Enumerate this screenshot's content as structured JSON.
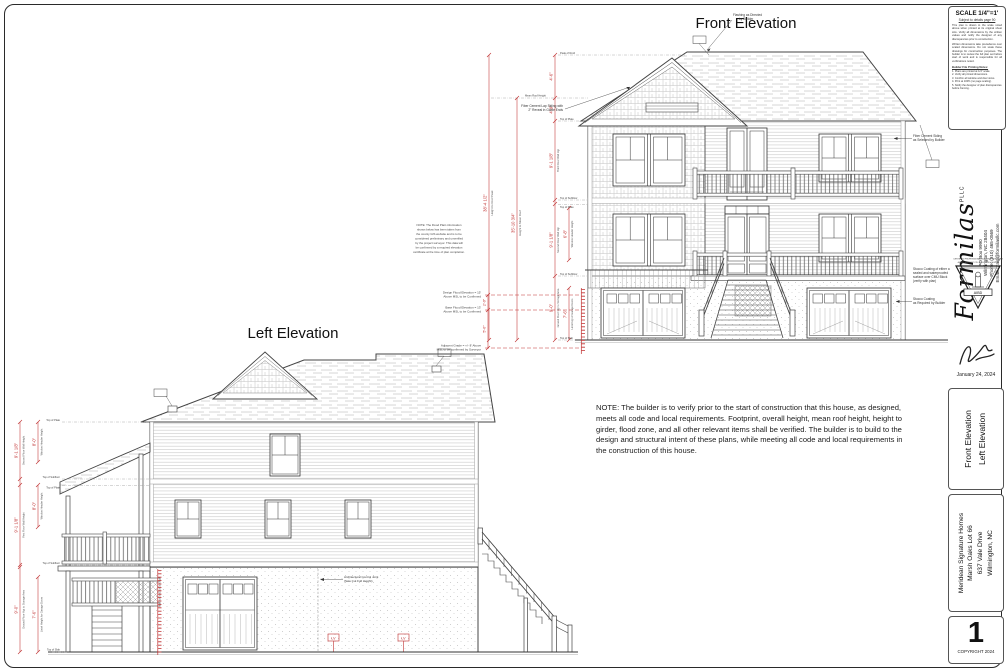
{
  "sheet": {
    "front_title": "Front Elevation",
    "left_title": "Left Elevation",
    "builder_note": "NOTE:  The builder is to verify prior to the start of construction that this house, as designed, meets all code and local requirements.  Footprint, overall height, mean roof height, height to girder, flood zone, and all other relevant items shall be verified.  The builder is to build to the design and structural intent of these plans, while meeting all code and local requirements in the construction of this house."
  },
  "labels": {
    "peak_of_roof": "Peak of Roof",
    "mean_roof": "Mean Roof Height",
    "top_of_plate": "Top of Plate",
    "top_of_subfloor": "Top of Subfloor",
    "top_of_slab": "Top of Slab"
  },
  "front": {
    "ann_flashing_1": "Flashing as Directed",
    "ann_flashing_2": "by Builder",
    "ann_gable_1": "Fiber Cement Lap Siding with",
    "ann_gable_2": "2\" Reveal in Gable Ends",
    "ann_siding_1": "Fiber Cement Siding",
    "ann_siding_2": "as Selected by Builder",
    "ann_stucco1_1": "Stucco Coating of either a",
    "ann_stucco1_2": "sealed and waterproofed",
    "ann_stucco1_3": "surface over CMU Block",
    "ann_stucco1_4": "(verify with plan)",
    "ann_stucco2_1": "Stucco Coating",
    "ann_stucco2_2": "as Required by Builder",
    "dim_seg_a": "4'-6\"",
    "dim_seg_b": "4'-9\"",
    "dim_floor3": "9'-1 1/8\"",
    "dim_floor3_lbl": "Third Floor Wall Hgt",
    "dim_floor2": "9'-1 1/8\"",
    "dim_floor2_lbl": "Second Floor Wall Hgt",
    "dim_header": "6'-8\"",
    "dim_header_lbl": "Window Header Height",
    "dim_ground": "9'-0\"",
    "dim_ground_lbl": "Ground Floor Hgt to Storage Area",
    "dim_lintel": "7'-6\"",
    "dim_lintel_lbl": "Lintel Hgt of Garage Doors",
    "dim_overall1": "38'-4 1/2\"",
    "dim_overall1_lbl": "Height to Roof Peak",
    "dim_overall2": "35'-10 3/4\"",
    "dim_overall2_lbl": "Height to Mean Roof"
  },
  "flood": {
    "note_l1": "NOTE:  The Flood Plain information",
    "note_l2": "shown below has been taken from",
    "note_l3": "the county GIS website and is to be",
    "note_l4": "considered preliminary and unverified",
    "note_l5": "by the project surveyor.  This data will",
    "note_l6": "be confirmed by a required elevation",
    "note_l7": "certificate at the time of plan completion.",
    "dfe_1": "Design Flood Elevation = 15'",
    "dfe_2": "Above MSL to be Confirmed",
    "bfe_1": "Base Flood Elevation = 13'",
    "bfe_2": "Above MSL to be Confirmed",
    "grade_1": "Adjacent Grade = +/- 8' Above",
    "grade_2": "MSL to be confirmed by Surveyor",
    "dim_a": "2'-0\"",
    "dim_b": "5'-0\""
  },
  "left": {
    "dim_floor": "9'-1 1/8\"",
    "dim_floor2_lbl": "Second Floor Wall Height",
    "dim_floor1_lbl": "First Floor Wall Height",
    "dim_header": "8'-0\"",
    "dim_header_lbl": "Window Header Height",
    "dim_ground": "9'-0\"",
    "dim_ground_lbl": "Ground Floor Hgt to Storage Area",
    "dim_lintel": "7'-6\"",
    "dim_lintel_lbl": "Lintel Height for Garage Doors",
    "ann_joint_1": "Architectural Control Joint",
    "ann_joint_2": "(Saw Cut Full Height)",
    "vent": "LV"
  },
  "titleblock": {
    "scale_title": "SCALE 1/4\"=1'",
    "scale_sub": "Subject to details page 90",
    "scale_para1": "This plan is drawn to the scale noted above when printed at its original sheet size.  Verify all dimensions by the written values and notify the designer of any discrepancies prior to construction.",
    "scale_para2": "Written dimensions take precedence over scaled dimensions.  Do not scale these drawings for construction purposes.  The builder is to review the full plan set before start of work and is responsible for all verifications noted.",
    "notes_title": "Builder File Printing Notes:",
    "notes": [
      "1.  Plans are printed at 1/4\" scale.",
      "2.  Verify all printed dimensions.",
      "3.  Confirm all window and door sizes.",
      "4.  Print at 100% (no page scaling).",
      "5.  Notify the designer of plan discrepancies before framing."
    ],
    "firm_name": "Formilas",
    "firm_suffix": "PLLC",
    "firm_address1": "PO Box 9990",
    "firm_address2": "Wilmington, NC 28404",
    "firm_phone": "Phone:  (910) 465-0569",
    "firm_email": "Email:  craig@formilasllc.com",
    "seal_top": "CERTIFIED PROFESSIONAL BUILDING DESIGNER",
    "seal_sub": "AMERICAN INSTITUTE OF BUILDING DESIGN",
    "seal_banner": "AIBD",
    "date": "January 24, 2024",
    "sheet_name_line1": "Front Elevation",
    "sheet_name_line2": "Left Elevation",
    "project_line1": "Meridean Signature Homes",
    "project_line2": "Marsh Oaks Lot 66",
    "project_line3": "637 Vale Drive",
    "project_line4": "Wilmington, NC",
    "sheet_number": "1",
    "copyright": "COPYRIGHT 2024"
  }
}
